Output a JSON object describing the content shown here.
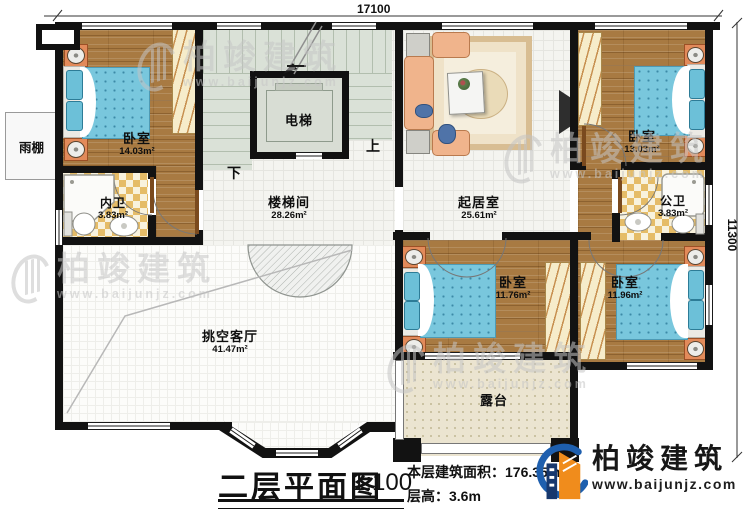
{
  "dimensions": {
    "width_label": "17100",
    "height_label": "11300"
  },
  "rooms": {
    "bedroom_tl": {
      "name": "卧室",
      "area": "14.03m²"
    },
    "bathroom_inner": {
      "name": "内卫",
      "area": "3.83m²"
    },
    "elevator": {
      "name": "电梯"
    },
    "stairwell": {
      "name": "楼梯间",
      "area": "28.26m²"
    },
    "living": {
      "name": "起居室",
      "area": "25.61m²"
    },
    "bedroom_tr": {
      "name": "卧室",
      "area": "13.03m²"
    },
    "bathroom_public": {
      "name": "公卫",
      "area": "3.83m²"
    },
    "bedroom_bm": {
      "name": "卧室",
      "area": "11.76m²"
    },
    "bedroom_br": {
      "name": "卧室",
      "area": "11.96m²"
    },
    "void_living": {
      "name": "挑空客厅",
      "area": "41.47m²"
    },
    "terrace": {
      "name": "露台"
    },
    "canopy": {
      "name": "雨棚"
    }
  },
  "stairs": {
    "up": "上",
    "down": "下"
  },
  "title_block": {
    "title": "二层平面图",
    "scale": "1:100",
    "area_label": "本层建筑面积：",
    "area_value": "176.35m²",
    "height_label": "层高：",
    "height_value": "3.6m"
  },
  "brand": {
    "name": "柏竣建筑",
    "website": "www.baijunjz.com"
  },
  "watermark": {
    "name": "柏竣建筑",
    "url": "www.baijunjz.com"
  },
  "colors": {
    "wall": "#121212",
    "wood": "#a87a42",
    "tile_warm": "#e5bc68",
    "stair": "#dae1d7",
    "blanket": "#79c7dd",
    "accent_blue": "#1e5fae",
    "accent_orange": "#f08c1c"
  }
}
